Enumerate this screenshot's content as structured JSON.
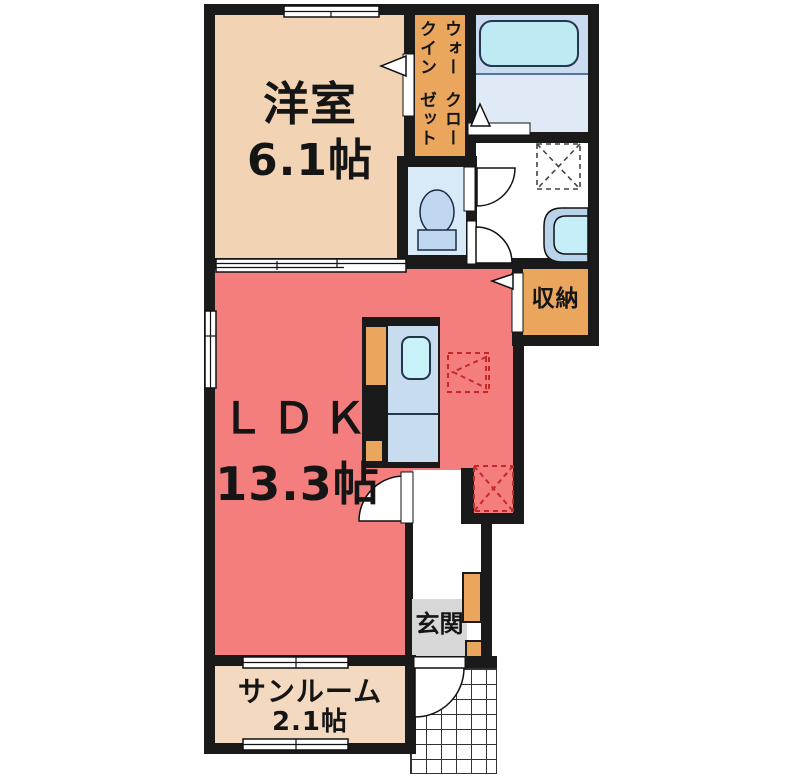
{
  "plan_title": "apartment floor plan",
  "rooms": {
    "western_room": {
      "name": "洋室",
      "size": "6.1帖"
    },
    "walk_in_closet": {
      "name_line1": "ウォークイン",
      "name_line2": "クローゼット"
    },
    "ldk": {
      "name": "ＬＤＫ",
      "size": "13.3帖"
    },
    "storage": {
      "name": "収納"
    },
    "entrance": {
      "name": "玄関"
    },
    "sunroom": {
      "name": "サンルーム",
      "size": "2.1帖"
    }
  },
  "fixtures": [
    "bathtub",
    "washbasin",
    "toilet",
    "kitchen-sink",
    "washing-machine-space",
    "refrigerator-space",
    "shoe-cabinet",
    "entrance-tile-porch"
  ],
  "colors": {
    "wall": "#1a1a1a",
    "western_room_fill": "#f2d4b5",
    "sunroom_fill": "#f3d9c0",
    "closet_orange": "#eba65e",
    "ldk_red": "#f47e7e",
    "bathroom_blue": "#c9dcf0",
    "bathroom_blue_light": "#dfeaf6",
    "bathtub_cyan": "#beeaf4",
    "toilet_room_blue": "#d8e9f8",
    "fixture_blue": "#c0d8ef",
    "sink_cyan": "#c5eef8",
    "counter_blue": "#c8dcf0",
    "genkan_gray": "#d7d7d7",
    "dashed_marker_red": "#c62828"
  }
}
